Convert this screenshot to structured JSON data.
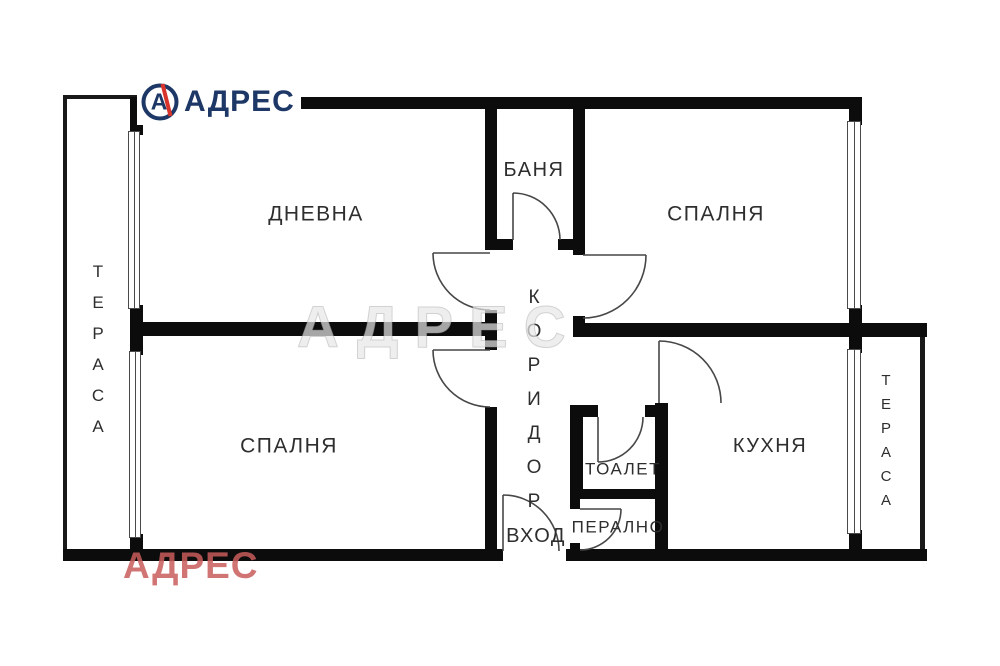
{
  "logo": {
    "brand": "АДРЕС",
    "monogram": "А",
    "navy": "#1d3766",
    "red": "#d9342b"
  },
  "watermarks": {
    "center": "АДРЕС",
    "bottom_left": "АДРЕС"
  },
  "rooms": {
    "living": "ДНЕВНА",
    "bathroom": "БАНЯ",
    "bedroom_top": "СПАЛНЯ",
    "bedroom_bottom": "СПАЛНЯ",
    "corridor": "КОРИДОР",
    "toilet": "ТОАЛЕТ",
    "laundry": "ПЕРАЛНО",
    "kitchen": "КУХНЯ",
    "entrance": "ВХОД",
    "terrace_left": "ТЕРАСА",
    "terrace_right": "ТЕРАСА"
  }
}
